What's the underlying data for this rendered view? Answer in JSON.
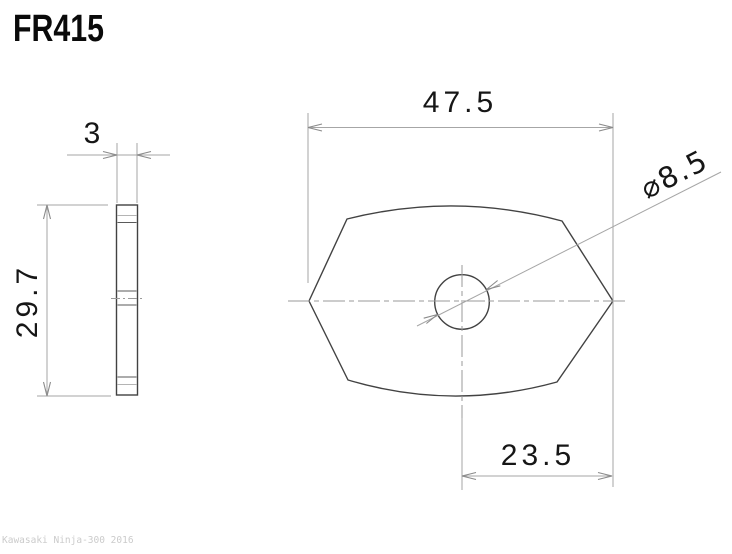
{
  "page": {
    "background": "#ffffff"
  },
  "header": {
    "part_number": "FR415"
  },
  "watermark": {
    "text": "Kawasaki Ninja-300 2016",
    "color": "#cbcbcb"
  },
  "drawing": {
    "type": "technical-dimension-drawing",
    "views": {
      "side_view": {
        "description": "thin plate profile, left",
        "thickness_mm": 3,
        "height_mm": 29.7
      },
      "front_view": {
        "description": "rounded hexagonal plate with center hole, right",
        "width_mm": 47.5,
        "hole_diameter_mm": 8.5,
        "hole_to_right_edge_mm": 23.5
      }
    },
    "dimension_labels": {
      "width": "47.5",
      "thickness": "3",
      "height": "29.7",
      "hole_offset": "23.5",
      "hole_diameter": "⌀8.5"
    },
    "colors": {
      "outline": "#424242",
      "dimension_lines": "#a6a6a6",
      "centerlines": "#9a9a9a",
      "dimension_text": "#161616",
      "watermark": "#cbcbcb"
    }
  }
}
